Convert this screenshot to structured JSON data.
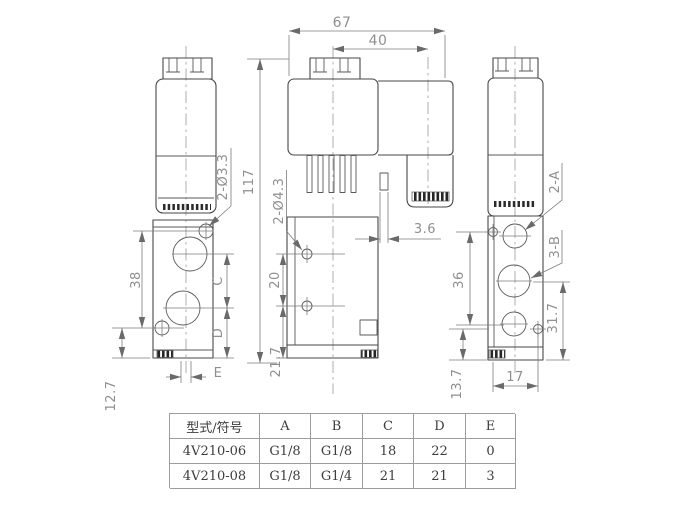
{
  "drawing": {
    "labels": {
      "holes_side": "2-Ø3.3",
      "holes_front": "2-Ø4.3",
      "ports_a": "2-A",
      "ports_b": "3-B"
    },
    "dims": {
      "overall_width": "67",
      "pin_pitch": "40",
      "overall_height": "117",
      "tab_offset": "3.6",
      "side_hole_pitch": "38",
      "side_port_c": "C",
      "side_port_d": "D",
      "side_e": "E",
      "side_bottom": "12.7",
      "front_hole_pitch": "20",
      "front_bottom": "21.7",
      "right_hole_pitch": "36",
      "right_bottom": "13.7",
      "right_port_height": "31.7",
      "right_width": "17"
    }
  },
  "table": {
    "headers": [
      "型式/符号",
      "A",
      "B",
      "C",
      "D",
      "E"
    ],
    "rows": [
      {
        "model": "4V210-06",
        "a": "G1/8",
        "b": "G1/8",
        "c": "18",
        "d": "22",
        "e": "0"
      },
      {
        "model": "4V210-08",
        "a": "G1/8",
        "b": "G1/4",
        "c": "21",
        "d": "21",
        "e": "3"
      }
    ]
  }
}
